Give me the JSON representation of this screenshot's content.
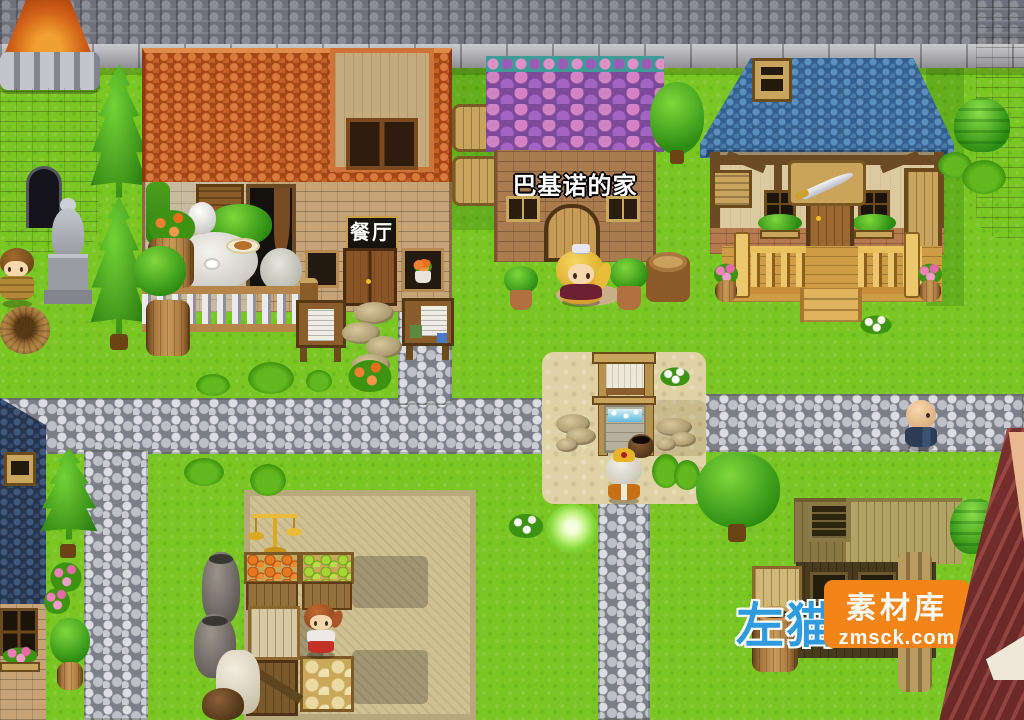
{
  "game": {
    "type": "rpg-maker-village-map",
    "signs": {
      "restaurant": "餐厅",
      "house_east": "巴基诺的家"
    },
    "watermark": {
      "left_text": "左猫",
      "brand": "素材库",
      "site": "zmsck.com",
      "box_color": "#f28418",
      "left_text_color": "#2f9ade"
    },
    "palette": {
      "grass": "#7ac624",
      "path": "#b2b2ba",
      "sand": "#dfd2a4",
      "restaurant_roof": "#bc5622",
      "bajino_roof": "#9a5cb4",
      "weapon_roof": "#4a79a8",
      "stone": "#9a9aa2",
      "wood": "#c9a45c",
      "navy_roof": "#31405e"
    },
    "characters": [
      {
        "id": "soldier",
        "sprite": "armored-soldier-sprite"
      },
      {
        "id": "princess",
        "sprite": "blonde-princess-sprite"
      },
      {
        "id": "well-villager",
        "sprite": "white-hood-villager-sprite"
      },
      {
        "id": "monk",
        "sprite": "bald-monk-sprite"
      },
      {
        "id": "child",
        "sprite": "red-clothes-child-sprite"
      }
    ],
    "props": [
      "west-tower",
      "east-tower",
      "statue",
      "well",
      "market-stall",
      "balance-scale",
      "notice-boards",
      "glow-orb",
      "wood-stacks",
      "barrels",
      "crates",
      "jars",
      "sack"
    ]
  }
}
